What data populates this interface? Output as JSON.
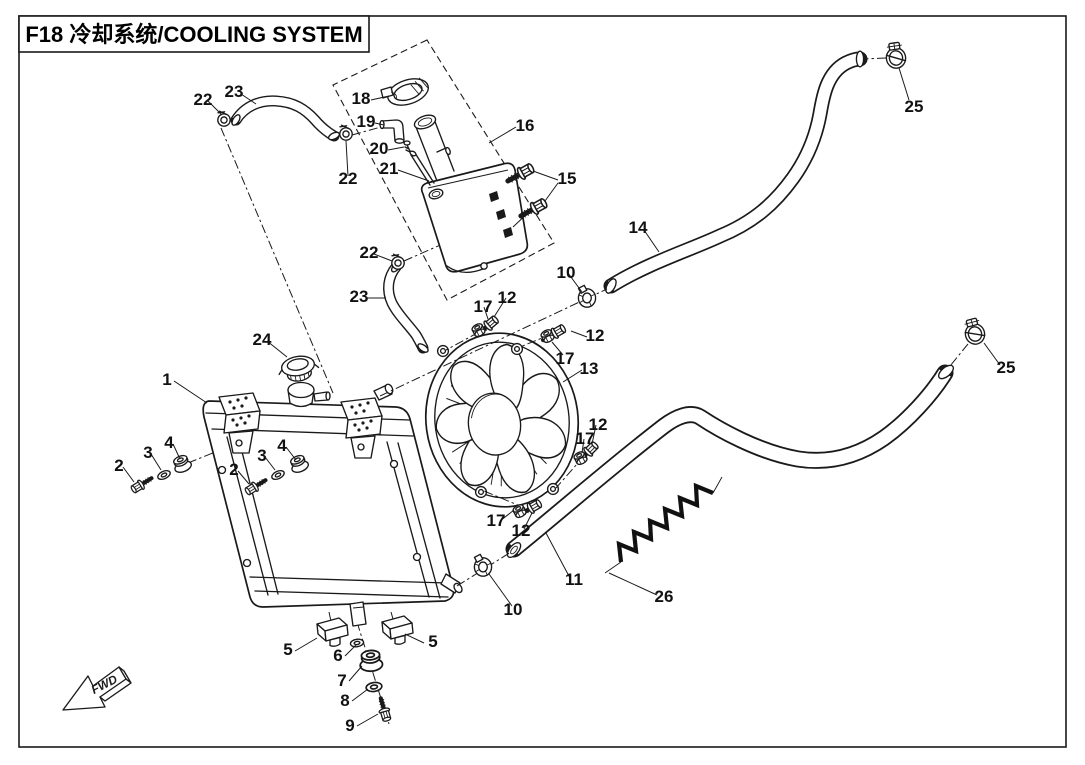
{
  "title": "F18 冷却系统/COOLING SYSTEM",
  "direction_marker": "FWD",
  "diagram": {
    "type": "exploded-parts-diagram",
    "subject": "F18 cooling system",
    "part_numbers_shown": [
      1,
      2,
      3,
      4,
      5,
      6,
      7,
      8,
      9,
      10,
      11,
      12,
      13,
      14,
      15,
      16,
      17,
      18,
      19,
      20,
      21,
      22,
      23,
      24,
      25,
      26
    ]
  },
  "callouts": [
    {
      "label": "22",
      "x": 203,
      "y": 105
    },
    {
      "label": "23",
      "x": 234,
      "y": 97
    },
    {
      "label": "18",
      "x": 361,
      "y": 104
    },
    {
      "label": "19",
      "x": 366,
      "y": 127
    },
    {
      "label": "20",
      "x": 379,
      "y": 154
    },
    {
      "label": "21",
      "x": 389,
      "y": 174
    },
    {
      "label": "16",
      "x": 525,
      "y": 131
    },
    {
      "label": "15",
      "x": 567,
      "y": 184
    },
    {
      "label": "22",
      "x": 348,
      "y": 184
    },
    {
      "label": "22",
      "x": 369,
      "y": 258
    },
    {
      "label": "23",
      "x": 359,
      "y": 302
    },
    {
      "label": "14",
      "x": 638,
      "y": 233
    },
    {
      "label": "25",
      "x": 914,
      "y": 112
    },
    {
      "label": "10",
      "x": 566,
      "y": 278
    },
    {
      "label": "24",
      "x": 262,
      "y": 345
    },
    {
      "label": "1",
      "x": 167,
      "y": 385
    },
    {
      "label": "17",
      "x": 483,
      "y": 312
    },
    {
      "label": "12",
      "x": 507,
      "y": 303
    },
    {
      "label": "12",
      "x": 595,
      "y": 341
    },
    {
      "label": "17",
      "x": 565,
      "y": 364
    },
    {
      "label": "13",
      "x": 589,
      "y": 374
    },
    {
      "label": "2",
      "x": 119,
      "y": 471
    },
    {
      "label": "3",
      "x": 148,
      "y": 458
    },
    {
      "label": "4",
      "x": 169,
      "y": 448
    },
    {
      "label": "2",
      "x": 234,
      "y": 475
    },
    {
      "label": "3",
      "x": 262,
      "y": 461
    },
    {
      "label": "4",
      "x": 282,
      "y": 451
    },
    {
      "label": "25",
      "x": 1006,
      "y": 373
    },
    {
      "label": "12",
      "x": 598,
      "y": 430
    },
    {
      "label": "17",
      "x": 585,
      "y": 444
    },
    {
      "label": "17",
      "x": 496,
      "y": 526
    },
    {
      "label": "12",
      "x": 521,
      "y": 536
    },
    {
      "label": "10",
      "x": 513,
      "y": 615
    },
    {
      "label": "11",
      "x": 574,
      "y": 585
    },
    {
      "label": "26",
      "x": 664,
      "y": 602
    },
    {
      "label": "5",
      "x": 288,
      "y": 655
    },
    {
      "label": "6",
      "x": 338,
      "y": 661
    },
    {
      "label": "5",
      "x": 433,
      "y": 647
    },
    {
      "label": "7",
      "x": 342,
      "y": 686
    },
    {
      "label": "8",
      "x": 345,
      "y": 706
    },
    {
      "label": "9",
      "x": 350,
      "y": 731
    }
  ]
}
